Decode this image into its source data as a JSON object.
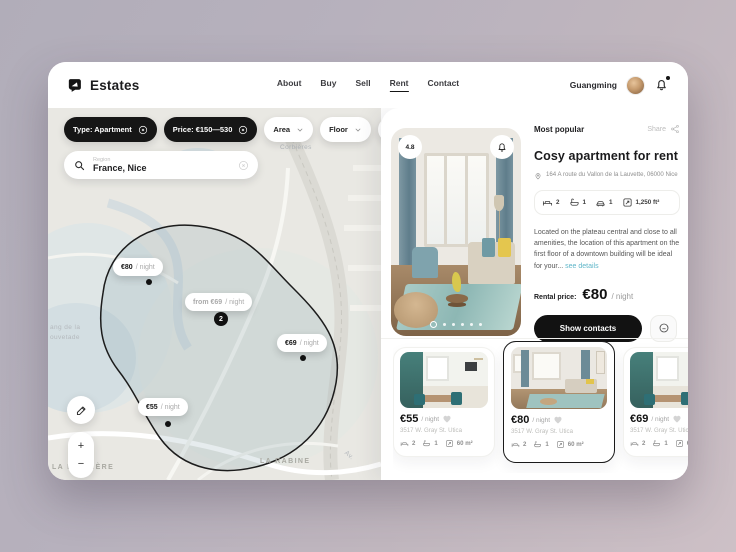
{
  "header": {
    "brand": "Estates",
    "nav": [
      {
        "label": "About"
      },
      {
        "label": "Buy"
      },
      {
        "label": "Sell"
      },
      {
        "label": "Rent"
      },
      {
        "label": "Contact"
      }
    ],
    "user": {
      "name": "Guangming"
    }
  },
  "filters": {
    "type_chip": "Type: Apartment",
    "price_chip": "Price: €150—530",
    "area_chip": "Area",
    "floor_chip": "Floor",
    "more_chip": "•••"
  },
  "search": {
    "label": "Region",
    "value": "France, Nice"
  },
  "map": {
    "labels": {
      "corbieres": "Corbières",
      "la_louviere": "LA LOUVIÈRE",
      "la_rabine": "LA RABINE",
      "etang1": "ang de la",
      "etang2": "ouvetade",
      "avenue": "Av."
    },
    "pins": [
      {
        "prefix": "",
        "price": "€80",
        "suffix": "/ night"
      },
      {
        "prefix": "from ",
        "price": "€69",
        "suffix": "/ night",
        "badge": "2"
      },
      {
        "prefix": "",
        "price": "€69",
        "suffix": "/ night"
      },
      {
        "prefix": "",
        "price": "€55",
        "suffix": "/ night"
      }
    ],
    "zoom_in": "+",
    "zoom_out": "−"
  },
  "listing": {
    "section_title": "Most popular",
    "share_label": "Share",
    "rating": "4.8",
    "title": "Cosy apartment for rent",
    "address": "164 A route du Vallon de la Lauvette, 06000 Nice",
    "amenities": [
      {
        "name": "beds",
        "value": "2"
      },
      {
        "name": "baths",
        "value": "1"
      },
      {
        "name": "parking",
        "value": "1"
      },
      {
        "name": "area",
        "value": "1,250 ft²"
      }
    ],
    "description": "Located on the plateau central and close to all amenities, the location of this apartment on the first floor of a downtown building will be ideal for your... ",
    "see_details": "see details",
    "rental_price_label": "Rental price:",
    "price": "€80",
    "price_suffix": "/ night",
    "cta": "Show contacts"
  },
  "cards": [
    {
      "price": "€55",
      "suffix": "/ night",
      "address": "3517 W. Gray St. Utica",
      "beds": "2",
      "baths": "1",
      "area": "60 m²"
    },
    {
      "price": "€80",
      "suffix": "/ night",
      "address": "3517 W. Gray St. Utica",
      "beds": "2",
      "baths": "1",
      "area": "60 m²"
    },
    {
      "price": "€69",
      "suffix": "/ night",
      "address": "3517 W. Gray St. Utica",
      "beds": "2",
      "baths": "1",
      "area": "60 m²"
    }
  ],
  "colors": {
    "accent": "#121212",
    "link": "#5fb6c9",
    "heart": "#d4d4d4",
    "map_zone_stroke": "#1c1c1c"
  }
}
